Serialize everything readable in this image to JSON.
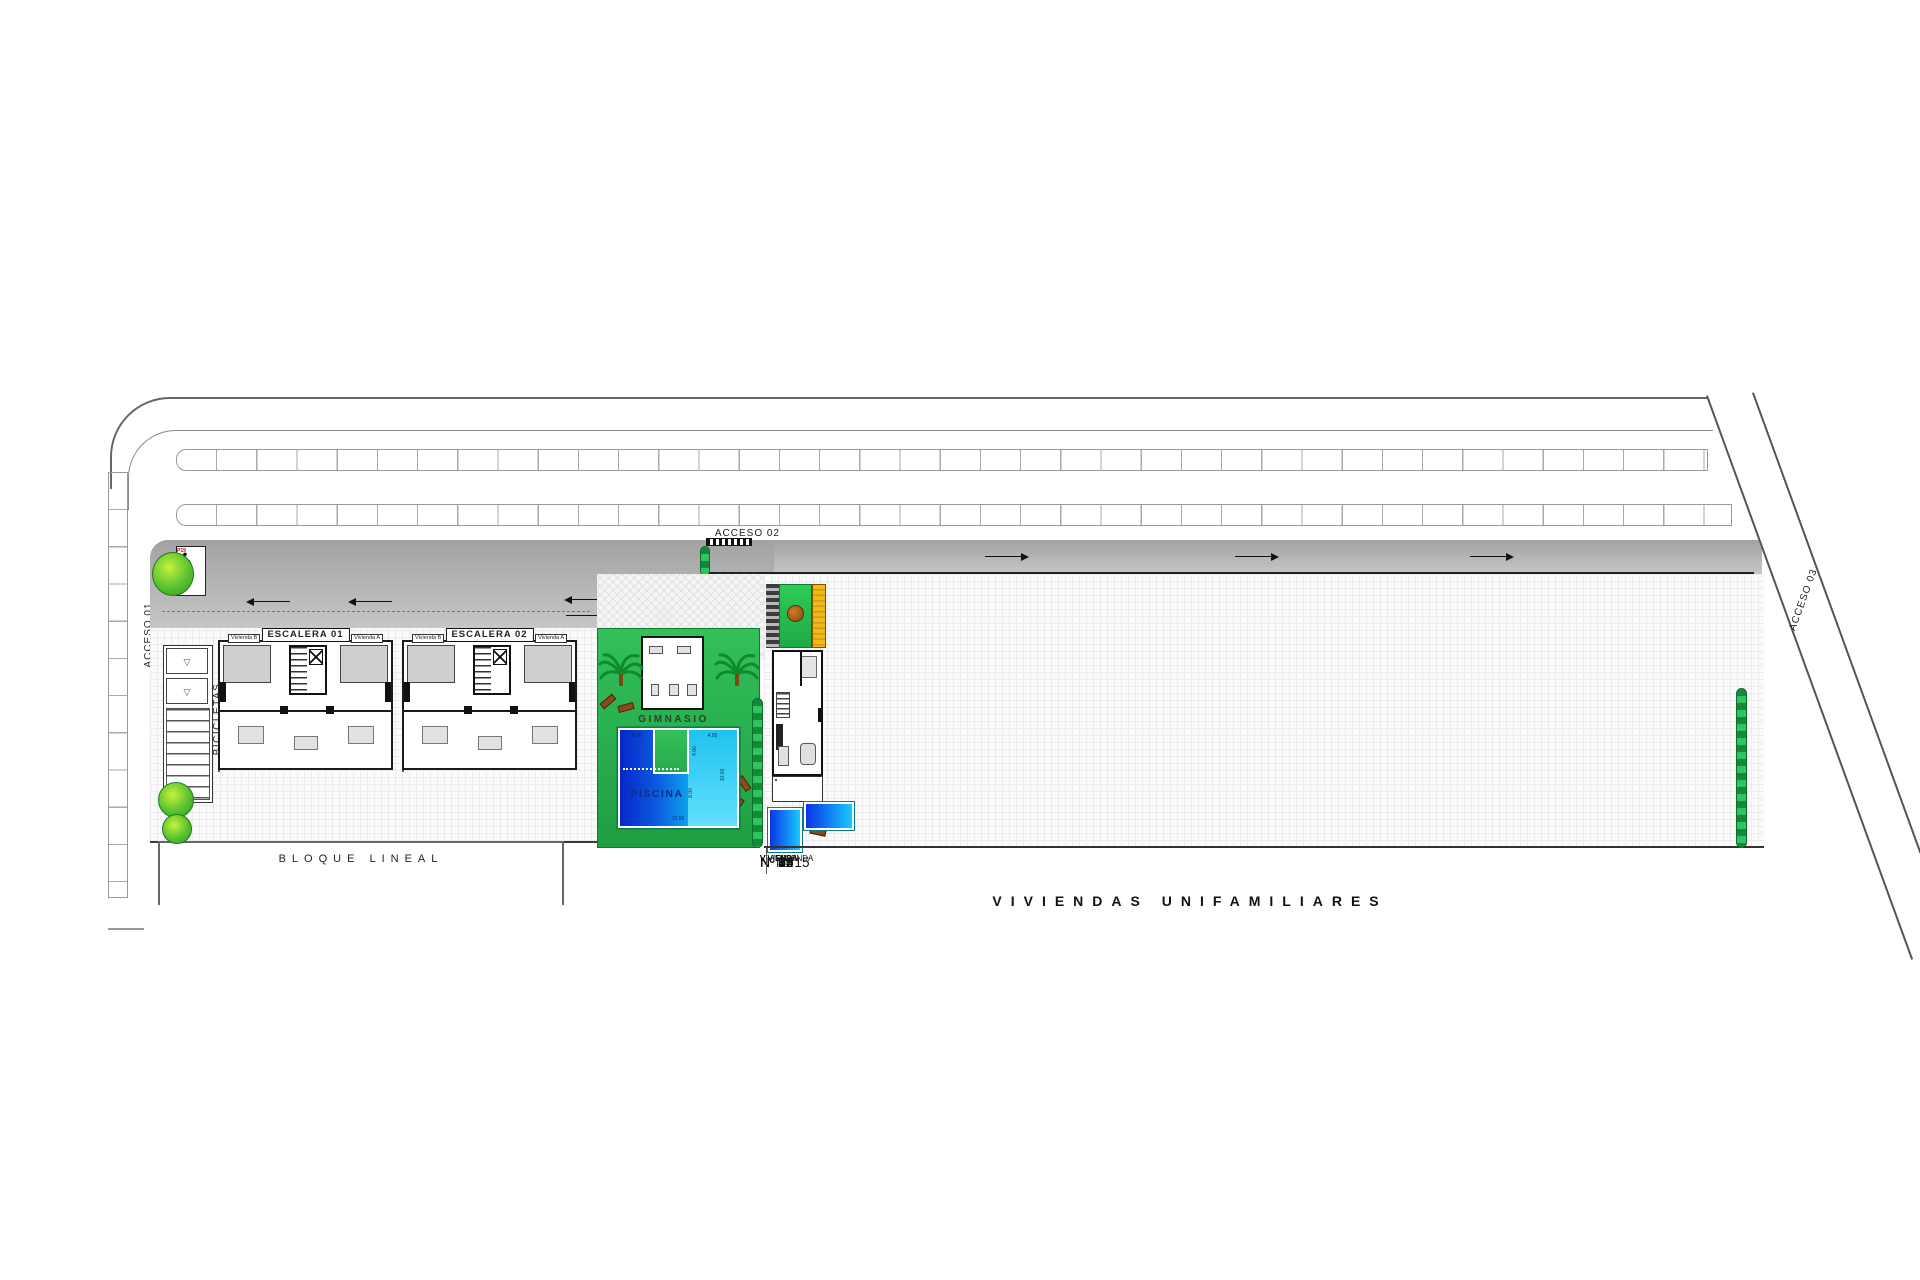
{
  "plan": {
    "accesses": {
      "a1": "ACCESO 01",
      "a2": "ACCESO 02",
      "a3": "ACCESO 03"
    },
    "bicicletas_label": "BICICLETAS",
    "bloque_lineal_label": "BLOQUE LINEAL",
    "gimnasio_label": "GIMNASIO",
    "piscina_label": "PISCINA",
    "viviendas_title": "VIVIENDAS UNIFAMILIARES",
    "buildings": [
      {
        "label": "ESCALERA 01",
        "unit_left": "Vivienda B",
        "unit_right": "Vivienda A"
      },
      {
        "label": "ESCALERA 02",
        "unit_left": "Vivienda B",
        "unit_right": "Vivienda A"
      }
    ],
    "pool_dimensions": {
      "top_left": "4.00",
      "top_right": "4.00",
      "notch_depth": "4.00",
      "right_height": "10.00",
      "inner_height": "8.00",
      "bottom_width": "12.00"
    },
    "parking_stalls": [
      {
        "id": "P01",
        "l1": "ESCALERA 1",
        "l2": "VIVIENDA",
        "l3": "BAJO A",
        "type": "std"
      },
      {
        "id": "P02",
        "l1": "ESCALERA 1",
        "l2": "VIVIENDA",
        "l3": "BAJO B",
        "type": "std"
      },
      {
        "id": "P03",
        "l1": "ESCALERA 1",
        "l2": "VIVIENDA",
        "l3": "1º A",
        "type": "std"
      },
      {
        "id": "P04",
        "l1": "ESCALERA 1",
        "l2": "VIVIENDA",
        "l3": "1º B",
        "type": "std"
      },
      {
        "id": "P05",
        "l1": "ESCALERA 1",
        "l2": "VIVIENDA",
        "l3": "2º A",
        "type": "std"
      },
      {
        "id": "P06",
        "l1": "ESCALERA 1",
        "l2": "VIVIENDA",
        "l3": "2º B",
        "type": "std"
      },
      {
        "id": "P07",
        "l1": "ESCALERA 1",
        "l2": "VIVIENDA",
        "l3": "3º A",
        "type": "std"
      },
      {
        "id": "P08",
        "l1": "ESCALERA 1",
        "l2": "VIVIENDA",
        "l3": "3º B",
        "type": "std"
      },
      {
        "id": "P09",
        "l1": "ESCALERA 2",
        "l2": "VIVIENDA",
        "l3": "BAJO A",
        "type": "std"
      },
      {
        "id": "P10",
        "l1": "ESCALERA 2",
        "l2": "VIVIENDA",
        "l3": "BAJO B",
        "type": "std"
      },
      {
        "id": "P11",
        "l1": "ESCALERA 2",
        "l2": "VIVIENDA",
        "l3": "1º A",
        "type": "std"
      },
      {
        "id": "P12",
        "l1": "ESCALERA 2",
        "l2": "VIVIENDA",
        "l3": "1º B",
        "type": "std"
      },
      {
        "id": "P13",
        "l1": "ESCALERA 2",
        "l2": "VIVIENDA",
        "l3": "2º A",
        "type": "std"
      },
      {
        "id": "P14",
        "l1": "ESCALERA 2",
        "l2": "VIVIENDA",
        "l3": "2º B",
        "type": "std"
      },
      {
        "id": "P15",
        "l1": "ESCALERA 2",
        "l2": "VIVIENDA",
        "l3": "3º A",
        "type": "std"
      },
      {
        "id": "P16",
        "l1": "ESCALERA 2",
        "l2": "VIVIENDA",
        "l3": "3º B",
        "type": "std"
      },
      {
        "id": "P17",
        "type": "pmr"
      },
      {
        "id": "P18",
        "type": "pmr"
      },
      {
        "id": "P19",
        "type": "pmr"
      }
    ],
    "villas": [
      {
        "label": "VIVIENDA",
        "number": "Nº 1"
      },
      {
        "label": "VIVIENDA",
        "number": "Nº 2"
      },
      {
        "label": "VIVIENDA",
        "number": "Nº 3"
      },
      {
        "label": "VIVIENDA",
        "number": "Nº 4"
      },
      {
        "label": "VIVIENDA",
        "number": "Nº 5"
      },
      {
        "label": "VIVIENDA",
        "number": "Nº 6"
      },
      {
        "label": "VIVIENDA",
        "number": "Nº 7"
      },
      {
        "label": "VIVIENDA",
        "number": "Nº 8"
      },
      {
        "label": "VIVIENDA",
        "number": "Nº 9"
      },
      {
        "label": "VIVIENDA",
        "number": "Nº 10"
      },
      {
        "label": "VIVIENDA",
        "number": "Nº 11"
      },
      {
        "label": "VIVIENDA",
        "number": "Nº 12"
      },
      {
        "label": "VIVIENDA",
        "number": "Nº 13"
      },
      {
        "label": "VIVIENDA",
        "number": "Nº 14"
      },
      {
        "label": "VIVIENDA",
        "number": "Nº 15"
      }
    ],
    "colors": {
      "road_gray": "#b3b3b3",
      "lawn_green": "#2aab4d",
      "pergola_yellow": "#f2b705",
      "pool_deep_blue": "#0726c8",
      "pool_cyan": "#1ec3ef",
      "stall_id_red": "#d10000",
      "tree_brown": "#b4621f"
    }
  }
}
